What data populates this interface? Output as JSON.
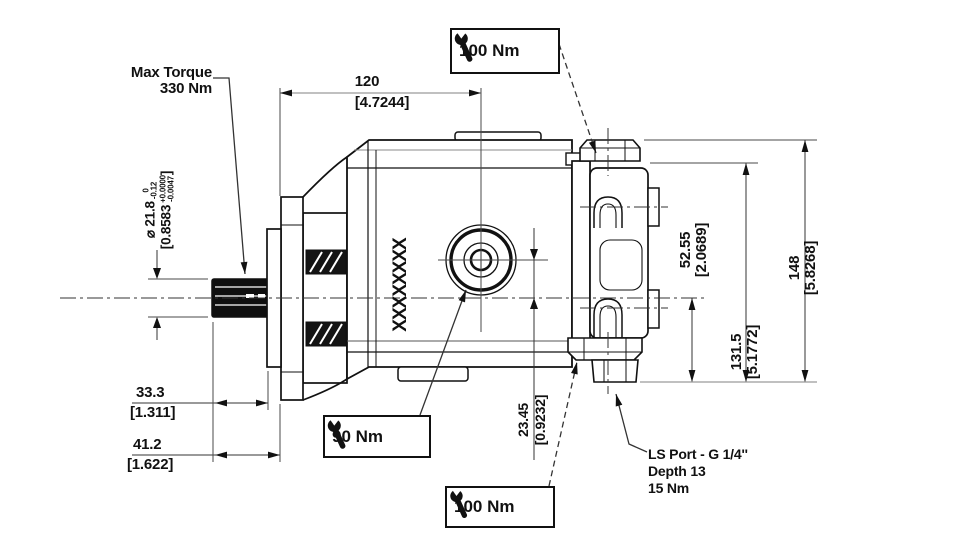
{
  "labels": {
    "max_torque_line1": "Max Torque",
    "max_torque_line2": "330 Nm",
    "body_marking": "XXXXXXXX",
    "ls_port_line1": "LS Port - G 1/4''",
    "ls_port_line2": "Depth 13",
    "ls_port_line3": "15 Nm"
  },
  "torque_callouts": {
    "top": "100 Nm",
    "middle": "90 Nm",
    "bottom": "100 Nm"
  },
  "dimensions": {
    "length_overall": {
      "mm": "120",
      "inch": "[4.7244]"
    },
    "shaft_diameter": {
      "symbol_and_mm": "⌀ 21.8",
      "mm_tol_upper": "0",
      "mm_tol_lower": "-0.12",
      "inch_open": "[0.8583",
      "inch_tol_upper": "+0.0000",
      "inch_tol_lower": "-0.0047",
      "inch_close": "]"
    },
    "shaft_length_short": {
      "mm": "33.3",
      "inch": "[1.311]"
    },
    "shaft_length_long": {
      "mm": "41.2",
      "inch": "[1.622]"
    },
    "axis_offset": {
      "mm": "23.45",
      "inch": "[0.9232]"
    },
    "height_axis_to_datum": {
      "mm": "52.55",
      "inch": "[2.0689]"
    },
    "height_cap_to_datum": {
      "mm": "131.5",
      "inch": "[5.1772]"
    },
    "height_overall": {
      "mm": "148",
      "inch": "[5.8268]"
    }
  },
  "colors": {
    "line": "#111111",
    "background": "#ffffff",
    "dim_gray": "#9a9a9a"
  }
}
